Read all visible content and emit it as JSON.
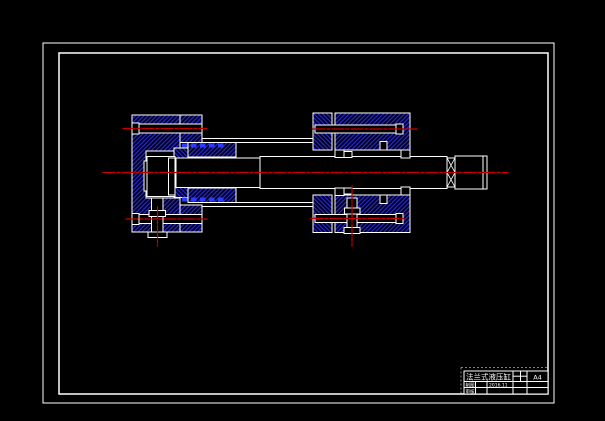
{
  "window": {
    "description": "CAD viewport showing sectional assembly drawing of a flange-type hydraulic cylinder",
    "background": "#000000"
  },
  "colors": {
    "outline_white": "#ffffff",
    "hatch_blue": "#2a2ad8",
    "hatch_base": "#00001a",
    "seal_blue": "#2b3bff",
    "centerline_red": "#c80000"
  },
  "title_block": {
    "part_name": "法兰式液压缸",
    "paper_size": "A4",
    "label_draw": "制图",
    "label_check": "审核",
    "value_date": "2016.11"
  }
}
